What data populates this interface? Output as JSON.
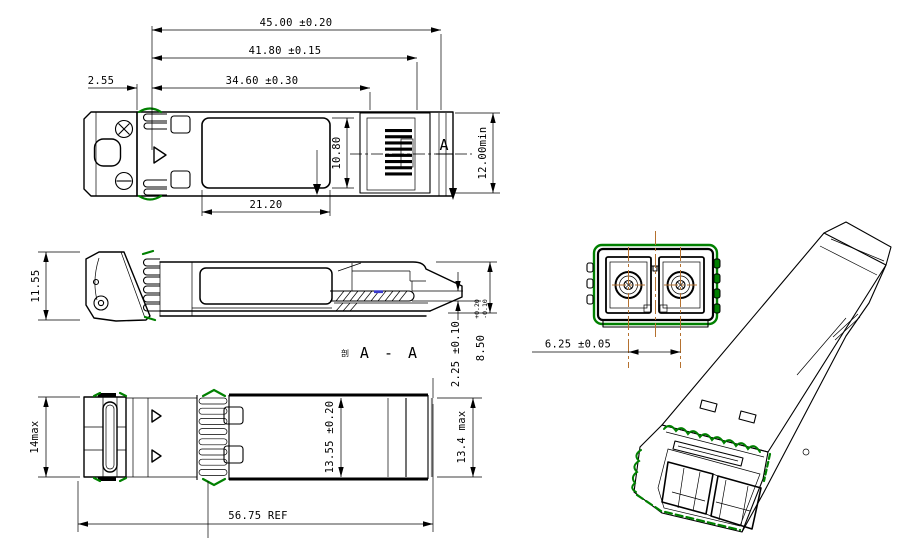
{
  "drawing": {
    "dims": {
      "d45": "45.00 ±0.20",
      "d4180": "41.80 ±0.15",
      "d3460": "34.60 ±0.30",
      "d255": "2.55",
      "d2120": "21.20",
      "d1080": "10.80",
      "d1200min": "12.00min",
      "d1155": "11.55",
      "d225": "2.25 ±0.10",
      "d850": "8.50",
      "d850_plus": "+0.20",
      "d850_minus": "-0.10",
      "d625": "6.25 ±0.05",
      "d14max": "14max",
      "d1355": "13.55 ±0.20",
      "d134max": "13.4 max",
      "d5675": "56.75 REF"
    },
    "section": {
      "cut_label": "A",
      "view_prefix": "剖",
      "view_label": "A - A"
    },
    "colors": {
      "line": "#000000",
      "gasket_green": "#008000",
      "centerline_orange": "#b5712f",
      "pcb_highlight_blue": "#3a3acc",
      "background": "#ffffff"
    }
  }
}
